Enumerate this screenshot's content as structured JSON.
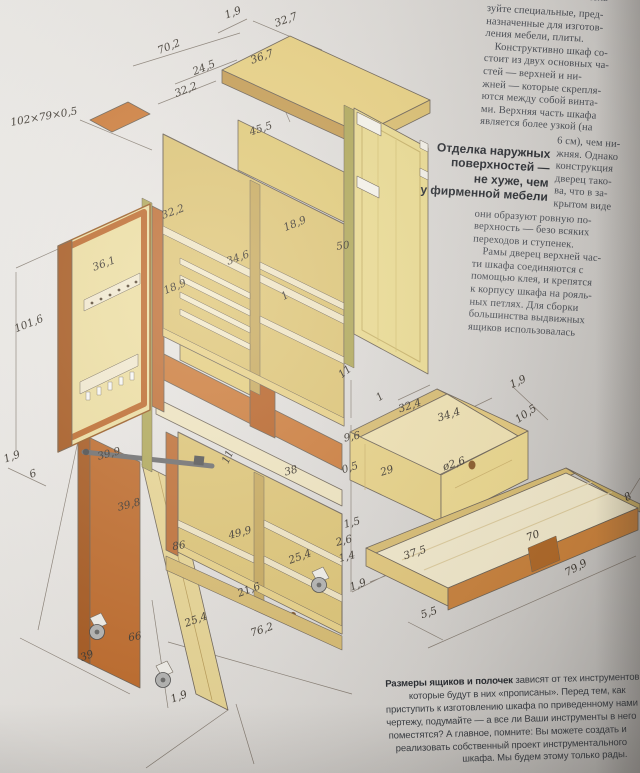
{
  "article": {
    "clipped_top_line": "исполь-",
    "para1": "зуйте специальные, пред-\nназначенные для изготов-\nления мебели, плиты.",
    "para2a": "Конструктивно шкаф со-\nстоит из двух основных ча-\nстей — верхней и ни-\nжней — которые скрепля-\nются между собой винта-\nми. Верхняя часть шкафа\nявляется более узкой (на",
    "para2b_narrow": "6 см), чем ни-\nжняя. Однако\nконструкция\nдверец тако-\nва, что в за-\nкрытом виде",
    "para2c": "они образуют ровную по-\nверхность — безо всяких\nпереходов и ступенек.",
    "para3": "Рамы дверец верхней час-\nти шкафа соединяются с\nпомощью клея, и крепятся\nк корпусу шкафа на рояль-\nных петлях. Для сборки\nбольшинства выдвижных\nящиков использовалась",
    "pullquote": "Отделка наружных\nповерхностей —\nне хуже, чем\nу фирменной мебели",
    "footer_note": {
      "lead": "Размеры ящиков и полочек",
      "lines": [
        " зависят от тех инструментов,",
        "которые будут в них «прописаны». Перед тем, как",
        "приступить к изготовлению шкафа по приведенному нами",
        "чертежу, подумайте — а все ли Ваши инструменты в него",
        "поместятся? А главное, помните: Вы можете создать и",
        "реализовать собственный проект инструментального",
        "шкафа. Мы будем этому только рады."
      ]
    }
  },
  "diagram": {
    "description": "Изометрический чертёж инструментального шкафа с размерами в сантиметрах",
    "dimensions": [
      {
        "t": "1,9",
        "x": 233,
        "y": 13,
        "r": -20
      },
      {
        "t": "32,7",
        "x": 286,
        "y": 20,
        "r": -20
      },
      {
        "t": "70,2",
        "x": 169,
        "y": 47,
        "r": -22
      },
      {
        "t": "36,7",
        "x": 262,
        "y": 57,
        "r": -20
      },
      {
        "t": "24,5",
        "x": 204,
        "y": 68,
        "r": -22
      },
      {
        "t": "32,2",
        "x": 186,
        "y": 90,
        "r": -22
      },
      {
        "t": "45,5",
        "x": 261,
        "y": 129,
        "r": -18
      },
      {
        "t": "102×79×0,5",
        "x": 44,
        "y": 117,
        "r": -10
      },
      {
        "t": "32,2",
        "x": 173,
        "y": 212,
        "r": -20
      },
      {
        "t": "18,9",
        "x": 295,
        "y": 224,
        "r": -22
      },
      {
        "t": "50",
        "x": 343,
        "y": 246,
        "r": -8
      },
      {
        "t": "34,6",
        "x": 238,
        "y": 258,
        "r": -20
      },
      {
        "t": "36,1",
        "x": 104,
        "y": 264,
        "r": -20
      },
      {
        "t": "18,9",
        "x": 175,
        "y": 287,
        "r": -22
      },
      {
        "t": "1",
        "x": 285,
        "y": 296,
        "r": -30
      },
      {
        "t": "101,6",
        "x": 29,
        "y": 324,
        "r": -22
      },
      {
        "t": "11",
        "x": 345,
        "y": 372,
        "r": -38
      },
      {
        "t": "1",
        "x": 380,
        "y": 397,
        "r": -35
      },
      {
        "t": "32,4",
        "x": 410,
        "y": 406,
        "r": -18
      },
      {
        "t": "34,4",
        "x": 449,
        "y": 415,
        "r": -18
      },
      {
        "t": "1,9",
        "x": 518,
        "y": 382,
        "r": -25
      },
      {
        "t": "10,5",
        "x": 526,
        "y": 414,
        "r": -35
      },
      {
        "t": "9,6",
        "x": 352,
        "y": 437,
        "r": -12
      },
      {
        "t": "0,5",
        "x": 350,
        "y": 468,
        "r": -18
      },
      {
        "t": "29",
        "x": 387,
        "y": 471,
        "r": -18
      },
      {
        "t": "ø2,6",
        "x": 454,
        "y": 464,
        "r": -18
      },
      {
        "t": "1,9",
        "x": 12,
        "y": 457,
        "r": -20
      },
      {
        "t": "6",
        "x": 33,
        "y": 474,
        "r": -20
      },
      {
        "t": "39,9",
        "x": 109,
        "y": 454,
        "r": -15
      },
      {
        "t": "39,8",
        "x": 129,
        "y": 505,
        "r": -15
      },
      {
        "t": "11",
        "x": 228,
        "y": 457,
        "r": -65
      },
      {
        "t": "38",
        "x": 291,
        "y": 471,
        "r": -15
      },
      {
        "t": "49,9",
        "x": 240,
        "y": 533,
        "r": -15
      },
      {
        "t": "86",
        "x": 179,
        "y": 546,
        "r": -10
      },
      {
        "t": "25,4",
        "x": 300,
        "y": 557,
        "r": -20
      },
      {
        "t": "1,5",
        "x": 352,
        "y": 523,
        "r": -15
      },
      {
        "t": "2,6",
        "x": 344,
        "y": 541,
        "r": -15
      },
      {
        "t": "1,4",
        "x": 347,
        "y": 557,
        "r": -15
      },
      {
        "t": "37,5",
        "x": 415,
        "y": 553,
        "r": -18
      },
      {
        "t": "1,9",
        "x": 358,
        "y": 585,
        "r": -20
      },
      {
        "t": "70",
        "x": 533,
        "y": 536,
        "r": -20
      },
      {
        "t": "79,9",
        "x": 576,
        "y": 568,
        "r": -28
      },
      {
        "t": "5,5",
        "x": 429,
        "y": 613,
        "r": -18
      },
      {
        "t": "8",
        "x": 628,
        "y": 497,
        "r": -30
      },
      {
        "t": "21,6",
        "x": 249,
        "y": 590,
        "r": -20
      },
      {
        "t": "25,4",
        "x": 196,
        "y": 620,
        "r": -20
      },
      {
        "t": "76,2",
        "x": 262,
        "y": 630,
        "r": -18
      },
      {
        "t": "39",
        "x": 87,
        "y": 656,
        "r": -20
      },
      {
        "t": "66",
        "x": 135,
        "y": 637,
        "r": -10
      },
      {
        "t": "1,9",
        "x": 179,
        "y": 697,
        "r": -20
      }
    ]
  },
  "colors": {
    "paper": "#e6e3df",
    "wood_light": "#ead283",
    "wood_cream": "#f1e6c5",
    "wood_orange": "#c6732f",
    "hinge_green": "#b2aa5b",
    "line": "#6e6457",
    "text": "#4a4e55"
  }
}
